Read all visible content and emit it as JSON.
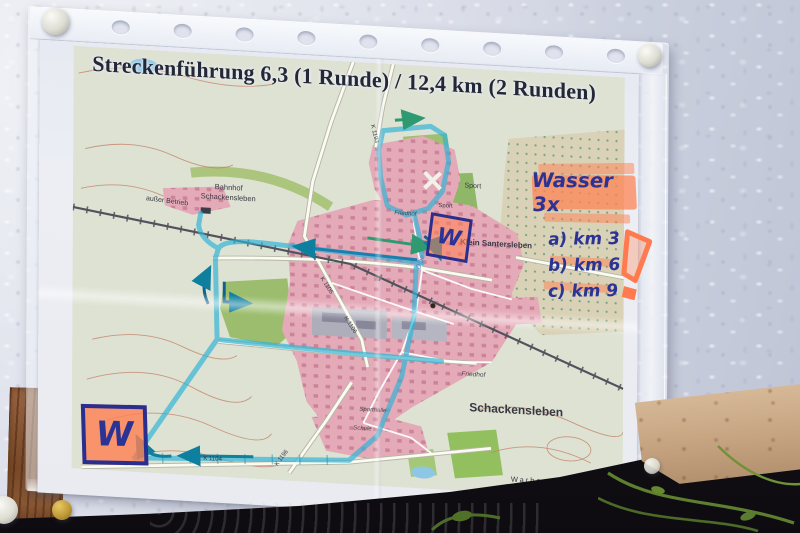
{
  "title": "Streckenführung 6,3 (1 Runde) / 12,4 km (2 Runden)",
  "annotations": {
    "wasser": "Wasser 3x",
    "km_items": [
      {
        "label": "a) km 3"
      },
      {
        "label": "b) km 6"
      },
      {
        "label": "c) km 9"
      }
    ],
    "water_marker_left": "W",
    "water_marker_top": "W",
    "exclamation": "!"
  },
  "map_labels": {
    "bahnhof_line1": "Bahnhof",
    "bahnhof_line2": "Schackensleben",
    "klein_santersleben": "Klein Santersleben",
    "sport": "Sport",
    "sport_2": "Sport",
    "friedhof_top": "Friedhof",
    "friedhof_bottom": "Friedhof",
    "town": "Schackensleben",
    "warberg": "Warberg",
    "ausser_betrieb": "außer Betrieb",
    "schule": "Schule",
    "sporthalle": "Sporthalle",
    "olbe": "Olbe",
    "k1104": "K 1104",
    "k1106": "K 1106",
    "k1106_2": "K 1106",
    "k1196": "K 1196",
    "k1193": "K 1193"
  },
  "colors": {
    "route_highlight": "#2fb3d6",
    "marker_highlighter": "#ff8456",
    "handwriting_ink": "#2b3394",
    "urban_area": "#e5aab8",
    "water": "#8ec7e6"
  }
}
